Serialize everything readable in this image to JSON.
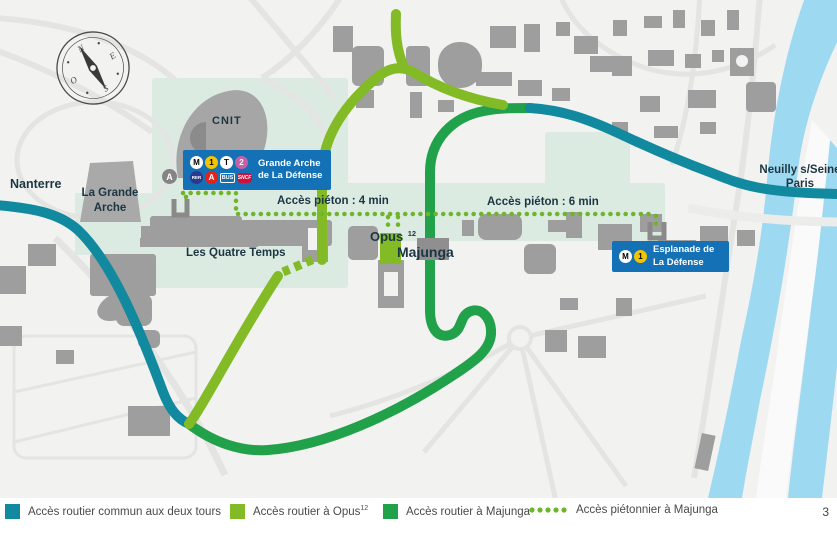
{
  "map": {
    "compass": {
      "n": "N",
      "e": "E",
      "s": "S",
      "o": "O"
    },
    "labels": {
      "nanterre": "Nanterre",
      "grande_arche_l1": "La Grande",
      "grande_arche_l2": "Arche",
      "cnit": "CNIT",
      "quatre_temps": "Les Quatre Temps",
      "opus": "Opus",
      "opus_sup": "12",
      "majunga": "Majunga",
      "pieton_4": "Accès piéton : 4 min",
      "pieton_6": "Accès piéton : 6 min",
      "neuilly_l1": "Neuilly s/Seine",
      "neuilly_l2": "Paris"
    },
    "icons": {
      "circled_a": "A"
    },
    "badges": {
      "grande_arche": {
        "line1": "Grande Arche",
        "line2": "de La Défense",
        "icons": {
          "metro": "M",
          "line1": "1",
          "tram": "T",
          "line2": "2",
          "rer": "RER",
          "rer_a": "A",
          "bus": "BUS",
          "sncf": "SNCF"
        }
      },
      "esplanade": {
        "line1": "Esplanade de",
        "line2": "La Défense",
        "icons": {
          "metro": "M",
          "line1": "1"
        }
      }
    }
  },
  "legend": {
    "items": [
      {
        "label": "Accès routier commun aux deux tours",
        "color": "#11899e",
        "type": "solid"
      },
      {
        "label": "Accès routier à Opus",
        "sup": "12",
        "color": "#82bb26",
        "type": "solid"
      },
      {
        "label": "Accès routier à Majunga",
        "color": "#22a14b",
        "type": "solid"
      },
      {
        "label": "Accès piétonnier à Majunga",
        "color": "#6fb52c",
        "type": "dotted"
      }
    ]
  },
  "page_number": "3",
  "colors": {
    "route_common": "#11899e",
    "route_opus": "#82bb26",
    "route_majunga": "#22a14b",
    "route_pedestrian": "#6fb52c",
    "badge_blue": "#1471b5",
    "esplanade_mint": "#dcebe2",
    "river_blue": "#9ed9f2",
    "building_gray": "#9e9e9e"
  }
}
